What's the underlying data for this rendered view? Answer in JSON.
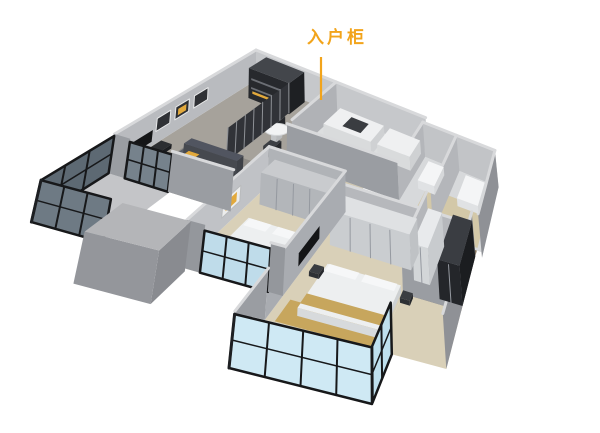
{
  "annotation": {
    "label": "入户柜"
  },
  "palette": {
    "accent": "#F2A41B",
    "accent_soft": "#E2A93C",
    "wall_light": "#C6C8CB",
    "wall_mid": "#9A9DA2",
    "wall_dark": "#8F9196",
    "wall_top": "#D8D9DB",
    "floor_living": "#A6A29B",
    "floor_warm": "#D9D0B8",
    "gold_floor": "#C7A65D",
    "glass_blue": "#CFE9F4",
    "glass_dark": "#5D6973",
    "frame_black": "#17181A",
    "furniture_dark": "#27292D",
    "sofa_gray": "#4A4E55",
    "white": "#EFF0F1",
    "background": "#FFFFFF"
  }
}
